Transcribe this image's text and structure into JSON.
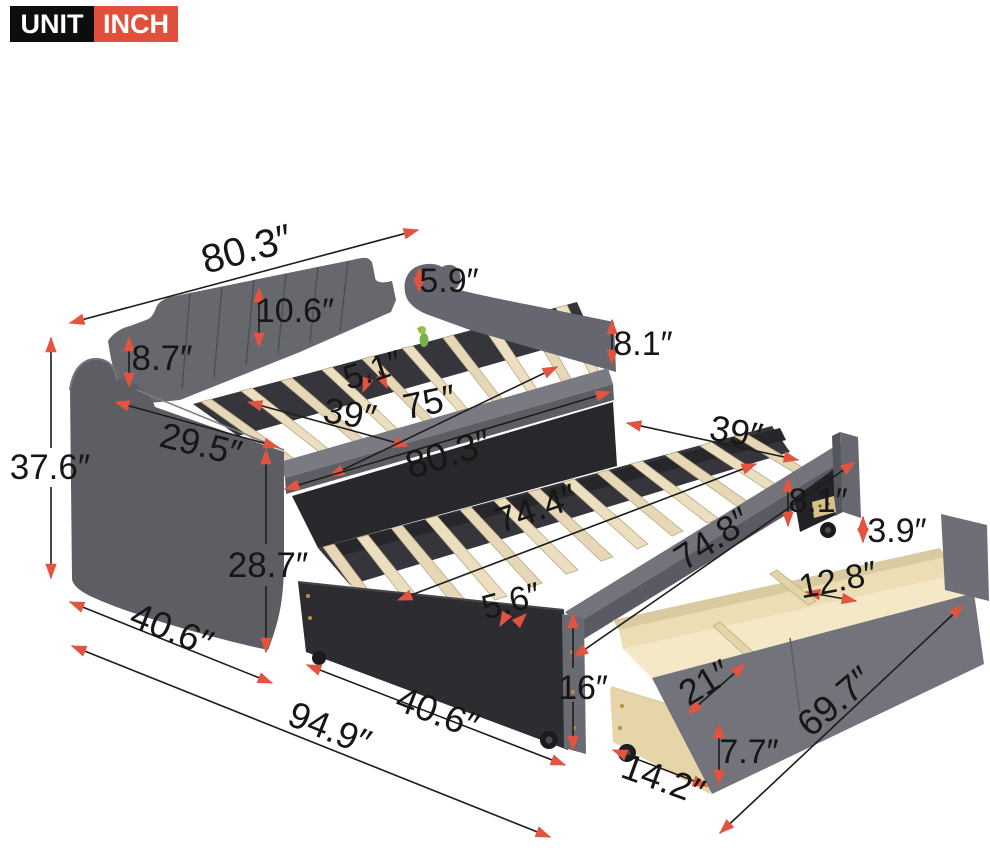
{
  "badge": {
    "unit_label": "UNIT",
    "unit_value": "INCH"
  },
  "colors": {
    "arrow_accent": "#e2543f",
    "badge_black": "#0d0d0d",
    "badge_red": "#e0503c",
    "fabric_gray": "#66666d",
    "slat_wood": "#e6d8b6",
    "drawer_wood": "#f2e5c2"
  },
  "dims": {
    "top_back_length": "80.3″",
    "arm_top_height": "5.9″",
    "backrest_height": "10.6″",
    "back_left_height": "8.7″",
    "daybed_foot_height": "8.1″",
    "daybed_slat_gap": "5.1″",
    "daybed_width": "39″",
    "daybed_inner_length": "75″",
    "daybed_length": "80.3″",
    "arm_depth": "29.5″",
    "overall_height": "37.6″",
    "arm_front_height": "28.7″",
    "trundle_width": "39″",
    "trundle_foot_height": "8.1″",
    "trundle_slat_length": "74.4″",
    "trundle_length": "74.8″",
    "drawer_depth": "3.9″",
    "drawer_mid_compartment": "12.8″",
    "trundle_height": "16″",
    "trundle_slat_gap": "5.6″",
    "base_width": "40.6″",
    "trundle_base_width": "40.6″",
    "overall_length": "94.9″",
    "drawer_length": "69.7″",
    "drawer_front_height": "7.7″",
    "drawer_width": "14.2″",
    "drawer_side_compartment": "21″"
  }
}
